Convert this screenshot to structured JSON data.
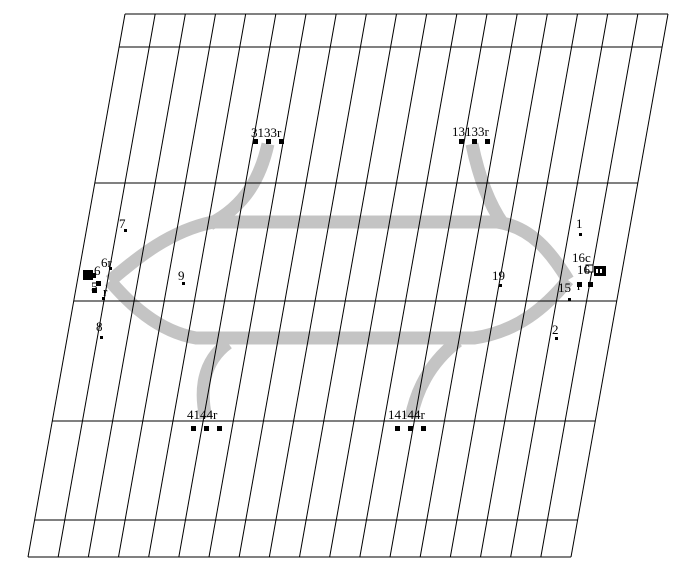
{
  "canvas": {
    "width": 686,
    "height": 570,
    "background": "#ffffff"
  },
  "colors": {
    "grid": "#000000",
    "track": "#c4c4c4",
    "text": "#000000",
    "marker": "#000000"
  },
  "grid": {
    "top_y": 14,
    "bottom_y": 557,
    "x_top_left": 125,
    "x_top_right": 668,
    "shear_dx": -97,
    "vertical_line_count": 19,
    "horizontal_line_ys": [
      14,
      47,
      183,
      301,
      421,
      520,
      557
    ]
  },
  "track": {
    "stroke_width": 13,
    "paths": [
      {
        "name": "upper-loop-track",
        "d": "M 110 281 C 138 257 170 231 213 222 L 497 222 C 531 227 551 252 568 280"
      },
      {
        "name": "lower-loop-track",
        "d": "M 110 281 C 129 303 157 331 196 338 L 474 338 C 517 332 546 307 568 280"
      },
      {
        "name": "ramp-top-left",
        "d": "M 268 144 C 261 175 247 205 210 224"
      },
      {
        "name": "ramp-top-right",
        "d": "M 472 144 C 478 173 487 201 503 224"
      },
      {
        "name": "ramp-bottom-left",
        "d": "M 206 418 C 200 392 202 362 228 343"
      },
      {
        "name": "ramp-bottom-right",
        "d": "M 411 418 C 416 392 428 364 458 341"
      }
    ]
  },
  "labels": [
    {
      "text": "3133r",
      "x": 251,
      "y": 137
    },
    {
      "text": "13133r",
      "x": 452,
      "y": 136
    },
    {
      "text": "4144r",
      "x": 187,
      "y": 419
    },
    {
      "text": "14144r",
      "x": 388,
      "y": 419
    },
    {
      "text": "7",
      "x": 119,
      "y": 228
    },
    {
      "text": "1",
      "x": 576,
      "y": 228
    },
    {
      "text": "9",
      "x": 178,
      "y": 280
    },
    {
      "text": "19",
      "x": 492,
      "y": 280
    },
    {
      "text": "8",
      "x": 96,
      "y": 331
    },
    {
      "text": "2",
      "x": 552,
      "y": 334
    },
    {
      "text": "6r",
      "x": 101,
      "y": 267
    },
    {
      "text": "6",
      "x": 94,
      "y": 275
    },
    {
      "text": "5",
      "x": 91,
      "y": 291
    },
    {
      "text": "r",
      "x": 103,
      "y": 296
    },
    {
      "text": "16c",
      "x": 572,
      "y": 262
    },
    {
      "text": "16",
      "x": 577,
      "y": 274
    },
    {
      "text": "15",
      "x": 558,
      "y": 292
    },
    {
      "text": "r",
      "x": 577,
      "y": 290
    }
  ],
  "marker_squares": [
    {
      "x": 253,
      "y": 139
    },
    {
      "x": 266,
      "y": 139
    },
    {
      "x": 279,
      "y": 139
    },
    {
      "x": 459,
      "y": 139
    },
    {
      "x": 472,
      "y": 139
    },
    {
      "x": 485,
      "y": 139
    },
    {
      "x": 191,
      "y": 426
    },
    {
      "x": 204,
      "y": 426
    },
    {
      "x": 217,
      "y": 426
    },
    {
      "x": 395,
      "y": 426
    },
    {
      "x": 408,
      "y": 426
    },
    {
      "x": 421,
      "y": 426
    },
    {
      "x": 91,
      "y": 273
    },
    {
      "x": 96,
      "y": 281
    },
    {
      "x": 92,
      "y": 288
    },
    {
      "x": 577,
      "y": 282
    },
    {
      "x": 588,
      "y": 282
    }
  ],
  "dots": [
    {
      "x": 124,
      "y": 229
    },
    {
      "x": 579,
      "y": 233
    },
    {
      "x": 182,
      "y": 282
    },
    {
      "x": 499,
      "y": 284
    },
    {
      "x": 100,
      "y": 336
    },
    {
      "x": 555,
      "y": 337
    },
    {
      "x": 102,
      "y": 297
    },
    {
      "x": 568,
      "y": 298
    },
    {
      "x": 109,
      "y": 267
    }
  ],
  "glyph_boxes": [
    {
      "type": "filled",
      "x": 83,
      "y": 270,
      "w": 10,
      "h": 10
    },
    {
      "type": "outline",
      "x": 586,
      "y": 265,
      "w": 7,
      "h": 7
    },
    {
      "type": "grid",
      "x": 594,
      "y": 266,
      "w": 12,
      "h": 10
    }
  ]
}
